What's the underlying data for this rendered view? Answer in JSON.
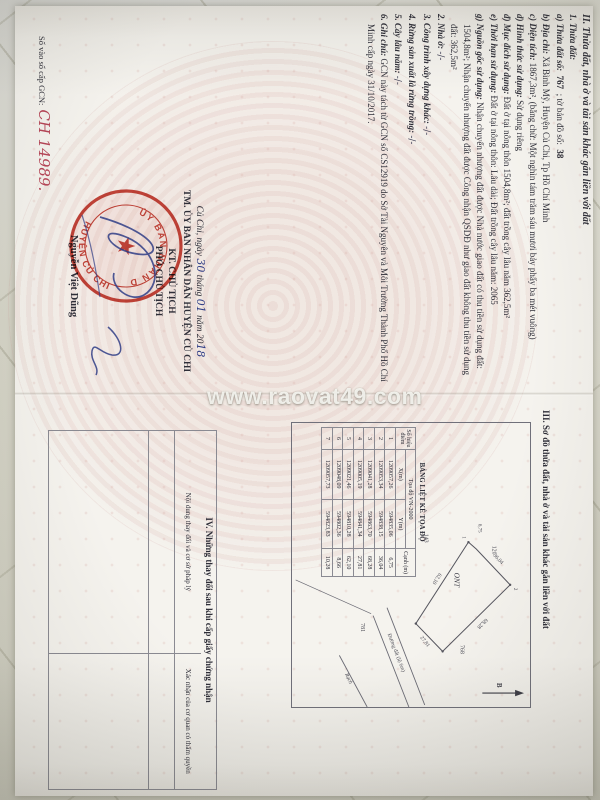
{
  "photo": {
    "watermark": "www.raovat49.com"
  },
  "colors": {
    "fabric": "#d9d8cc",
    "paper": "#f5f3ee",
    "seal_red": "#c4372c",
    "ink_blue": "#2f3d86",
    "registry_red": "#b64456"
  },
  "page2": {
    "section2": {
      "heading": "II. Thửa đất, nhà ở và tài sản khác gắn liền với đất",
      "sub1": "1. Thửa đất:",
      "a_label": "a) Thửa đất số:",
      "a_value": "767",
      "a_label2": "; tờ bản đồ số:",
      "a_value2": "38",
      "b_label": "b) Địa chỉ:",
      "b_text": "Xã Bình Mỹ, Huyện Củ Chi, Tp Hồ Chí Minh",
      "c_label": "c) Diện tích:",
      "c_text": "1867,3m², (bằng chữ: Một nghìn tám trăm sáu mươi bảy phẩy ba mét vuông)",
      "d_label": "d) Hình thức sử dụng:",
      "d_text": "Sử dụng riêng",
      "dd_label": "đ) Mục đích sử dụng:",
      "dd_text": "Đất ở tại nông thôn 1504,8m²; đất trồng cây lâu năm 362,5m²",
      "e_label": "e) Thời hạn sử dụng:",
      "e_text": "Đất ở tại nông thôn: Lâu dài; Đất trồng cây lâu năm: 2065",
      "g_label": "g) Nguồn gốc sử dụng:",
      "g_text": "Nhận chuyển nhượng đất được Nhà nước giao đất có thu tiền sử dụng đất: 1504,8m²; Nhận chuyển nhượng đất được Công nhận QSDĐ như giao đất không thu tiền sử dụng đất: 362,5m²",
      "n2_label": "2. Nhà ở:",
      "n3_label": "3. Công trình xây dựng khác:",
      "n4_label": "4. Rừng sản xuất là rừng trồng:",
      "n5_label": "5. Cây lâu năm:",
      "none_mark": "-/-",
      "n6_label": "6. Ghi chú:",
      "note": "GCN này tách từ GCN số CS12919 do Sở Tài Nguyên và Môi Trường Thành Phố Hồ Chí Minh cấp ngày 31/10/2017."
    },
    "signing": {
      "place_prefix": "Củ Chi, ngày",
      "day": "30",
      "thang": "tháng",
      "month": "01",
      "nam": "năm 20",
      "year_suffix": "18",
      "authority": "TM. ỦY BAN NHÂN DÂN HUYỆN CỦ CHI",
      "kt": "KT. CHỦ TỊCH",
      "title": "PHÓ CHỦ TỊCH",
      "signer": "Nguyễn Việt Dũng",
      "seal_top": "ỦY BAN NHÂN DÂN",
      "seal_bottom": "HUYỆN CỦ CHI",
      "seal_star": "★"
    },
    "registry": {
      "label": "Số vào sổ cấp GCN:",
      "number": "CH 14989."
    }
  },
  "page3": {
    "section3_heading": "III. Sơ đồ thửa đất, nhà ở và tài sản khác gắn liền với đất",
    "diagram": {
      "plot_label": "ONT",
      "neighbor_top": "120",
      "neighbor_left": "143",
      "neighbor_right": "768",
      "neighbor_bottom": "781",
      "edge1": "6,75",
      "edge2": "36,04",
      "edge3": "68,28",
      "edge4": "27,81",
      "edge5": "62,10",
      "corner1": "1",
      "corner2": "2",
      "road": "Đường đất (lộ 6m)",
      "canal": "Rạch",
      "north": "B"
    },
    "table": {
      "title": "BẢNG LIỆT KÊ TỌA ĐỘ",
      "col_point": "Số hiệu điểm",
      "col_group": "Tọa độ VN-2000",
      "col_x": "X(m)",
      "col_y": "Y(m)",
      "col_edge": "Cạnh (m)",
      "rows": [
        {
          "stt": "1",
          "x": "1209057,26",
          "y": "594835,06",
          "canh": "6,75"
        },
        {
          "stt": "2",
          "x": "1209053,34",
          "y": "594838,15",
          "canh": "36,04"
        },
        {
          "stt": "3",
          "x": "1209041,28",
          "y": "594863,70",
          "canh": "68,28"
        },
        {
          "stt": "4",
          "x": "1209005,19",
          "y": "594841,34",
          "canh": "27,81"
        },
        {
          "stt": "5",
          "x": "1209021,46",
          "y": "594810,28",
          "canh": "62,10"
        },
        {
          "stt": "6",
          "x": "1209048,09",
          "y": "594802,36",
          "canh": "8,66"
        },
        {
          "stt": "7",
          "x": "1209057,73",
          "y": "594823,83",
          "canh": "10,28"
        }
      ]
    },
    "section4": {
      "heading": "IV. Những thay đổi sau khi cấp giấy chứng nhận",
      "col1": "Nội dung thay đổi và cơ sở pháp lý",
      "col2": "Xác nhận của cơ quan có thẩm quyền"
    }
  }
}
